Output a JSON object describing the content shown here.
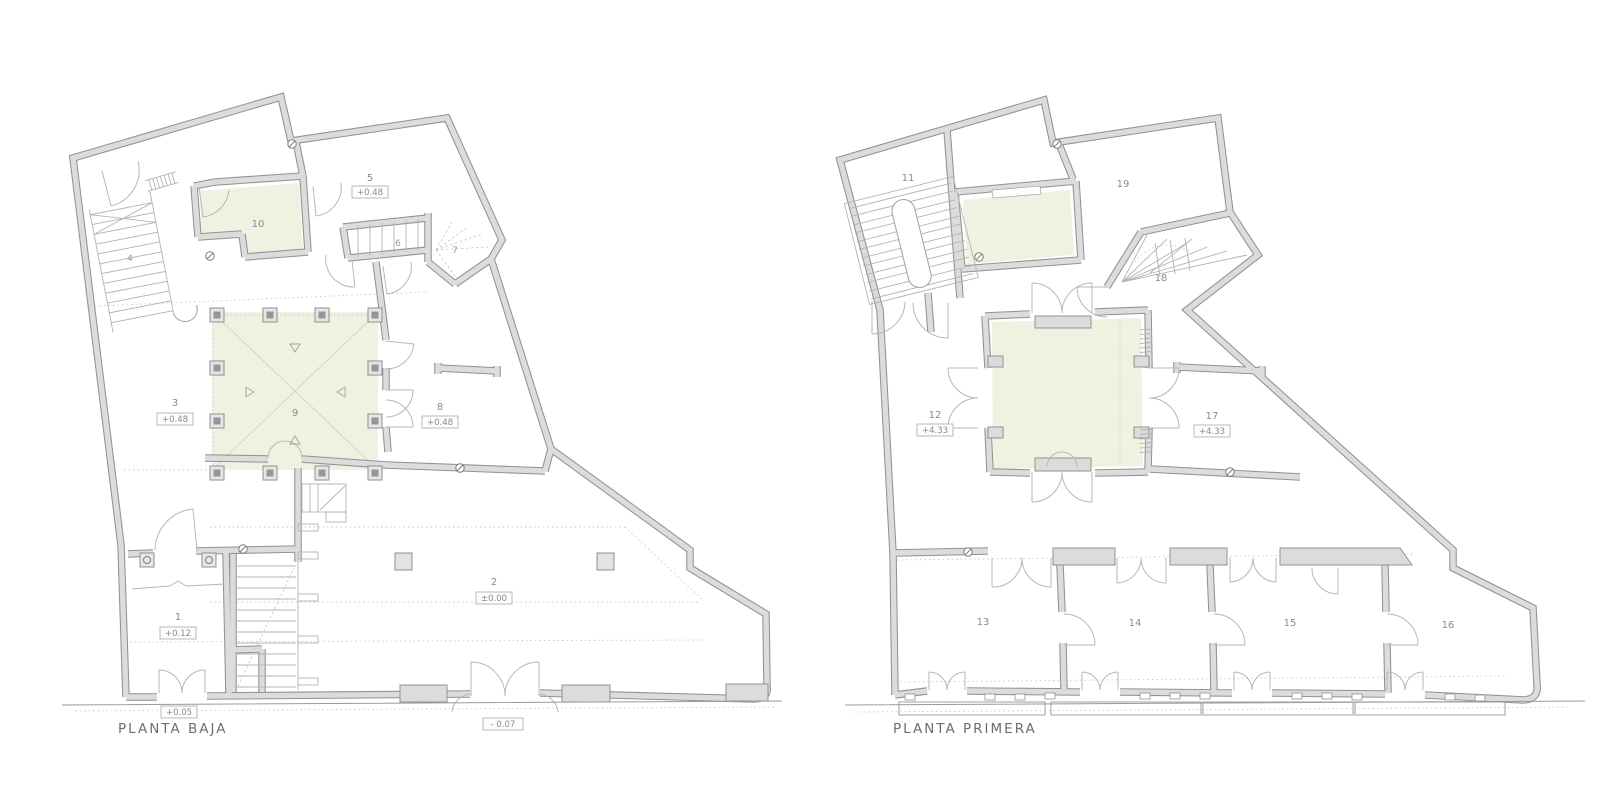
{
  "document": {
    "background": "#ffffff"
  },
  "plans": [
    {
      "title": "PLANTA BAJA",
      "rooms": {
        "r1": {
          "number": "1",
          "elevation": "+0.12"
        },
        "r2": {
          "number": "2",
          "elevation": "±0.00"
        },
        "r3": {
          "number": "3",
          "elevation": "+0.48"
        },
        "r4": {
          "number": "4"
        },
        "r5": {
          "number": "5",
          "elevation": "+0.48"
        },
        "r6": {
          "number": "6"
        },
        "r7": {
          "number": "7"
        },
        "r8": {
          "number": "8",
          "elevation": "+0.48"
        },
        "r9": {
          "number": "9"
        },
        "r10": {
          "number": "10"
        }
      },
      "street_levels": {
        "left": "+0.05",
        "right": "- 0.07"
      }
    },
    {
      "title": "PLANTA PRIMERA",
      "rooms": {
        "r11": {
          "number": "11"
        },
        "r12": {
          "number": "12",
          "elevation": "+4.33"
        },
        "r13": {
          "number": "13"
        },
        "r14": {
          "number": "14"
        },
        "r15": {
          "number": "15"
        },
        "r16": {
          "number": "16"
        },
        "r17": {
          "number": "17",
          "elevation": "+4.33"
        },
        "r18": {
          "number": "18"
        },
        "r19": {
          "number": "19"
        }
      }
    }
  ],
  "colors": {
    "wall_fill": "#dcdcdc",
    "wall_edge": "#929292",
    "accent_room_fill": "#eef2e1",
    "accent_room_line": "#d2d8bf",
    "line_light": "#b3b3b3",
    "line_dotted": "#c9c9c9",
    "text": "#8a8a8a",
    "title_text": "#6e6e6e",
    "background": "#ffffff"
  }
}
